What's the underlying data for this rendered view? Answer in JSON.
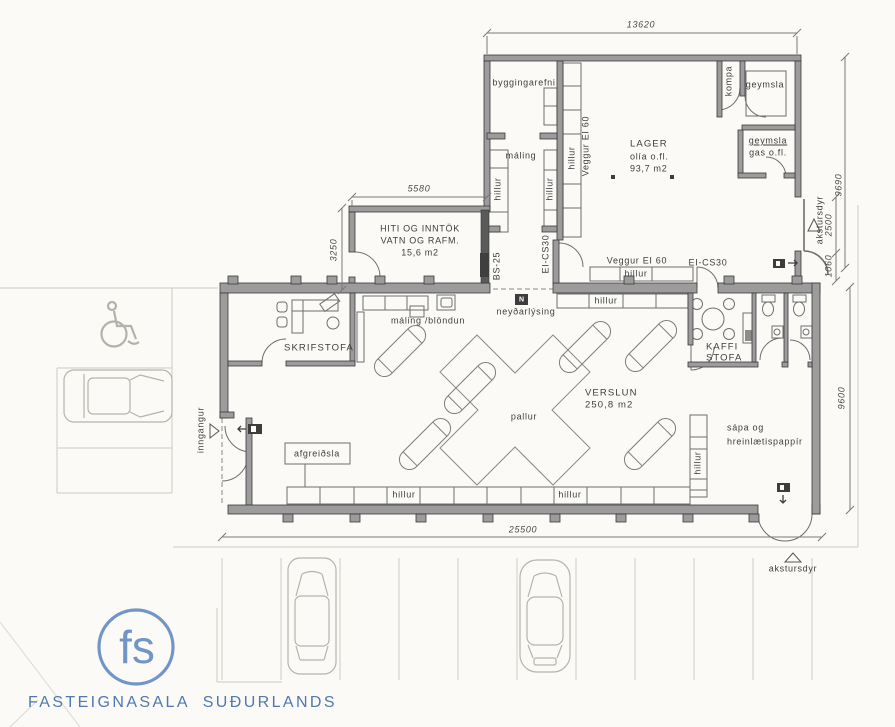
{
  "drawing": {
    "dimensions": {
      "top_width": "13620",
      "lager_height": "9690",
      "hiti_width": "5580",
      "hiti_height": "3250",
      "door_width": "2500",
      "door_offset": "1060",
      "shop_width": "25500",
      "shop_height": "9600"
    },
    "rooms": {
      "lager": {
        "name": "LAGER",
        "contents": "olía o.fl.",
        "area": "93,7 m2"
      },
      "byggingarefni": {
        "name": "byggingarefni"
      },
      "maling": {
        "name": "máling"
      },
      "kompa": {
        "name": "kompa"
      },
      "geymsla": {
        "name": "geymsla"
      },
      "geymsla_gas": {
        "name": "geymsla",
        "contents": "gas o.fl."
      },
      "hiti": {
        "line1": "HITI OG INNTÖK",
        "line2": "VATN OG RAFM.",
        "area": "15,6 m2"
      },
      "skrifstofa": {
        "name": "SKRIFSTOFA"
      },
      "kaffistofa": {
        "line1": "KAFFI",
        "line2": "STOFA"
      },
      "verslun": {
        "name": "VERSLUN",
        "area": "250,8 m2"
      }
    },
    "features": {
      "hillur": "hillur",
      "veggur_ei60": "Veggur EI 60",
      "ei_cs30": "EI-CS30",
      "bs25": "BS-25",
      "neydarlysing": "neyðarlýsing",
      "n_icon": "N",
      "maling_blondun": "máling /blöndun",
      "afgreidsla": "afgreiðsla",
      "pallur": "pallur",
      "sapa_line1": "sápa og",
      "sapa_line2": "hreinlætispappír",
      "inngangur": "inngangur",
      "akstursdyr": "akstursdyr"
    },
    "footer": {
      "logo": "fs",
      "company": "FASTEIGNASALA  SUÐURLANDS"
    },
    "colors": {
      "ink": "#3d3d3d",
      "wall_fill": "#9c9c9c",
      "faint": "#ccc9c3",
      "logo_blue": "#7295c8",
      "footer_text": "#4e79b2"
    }
  }
}
